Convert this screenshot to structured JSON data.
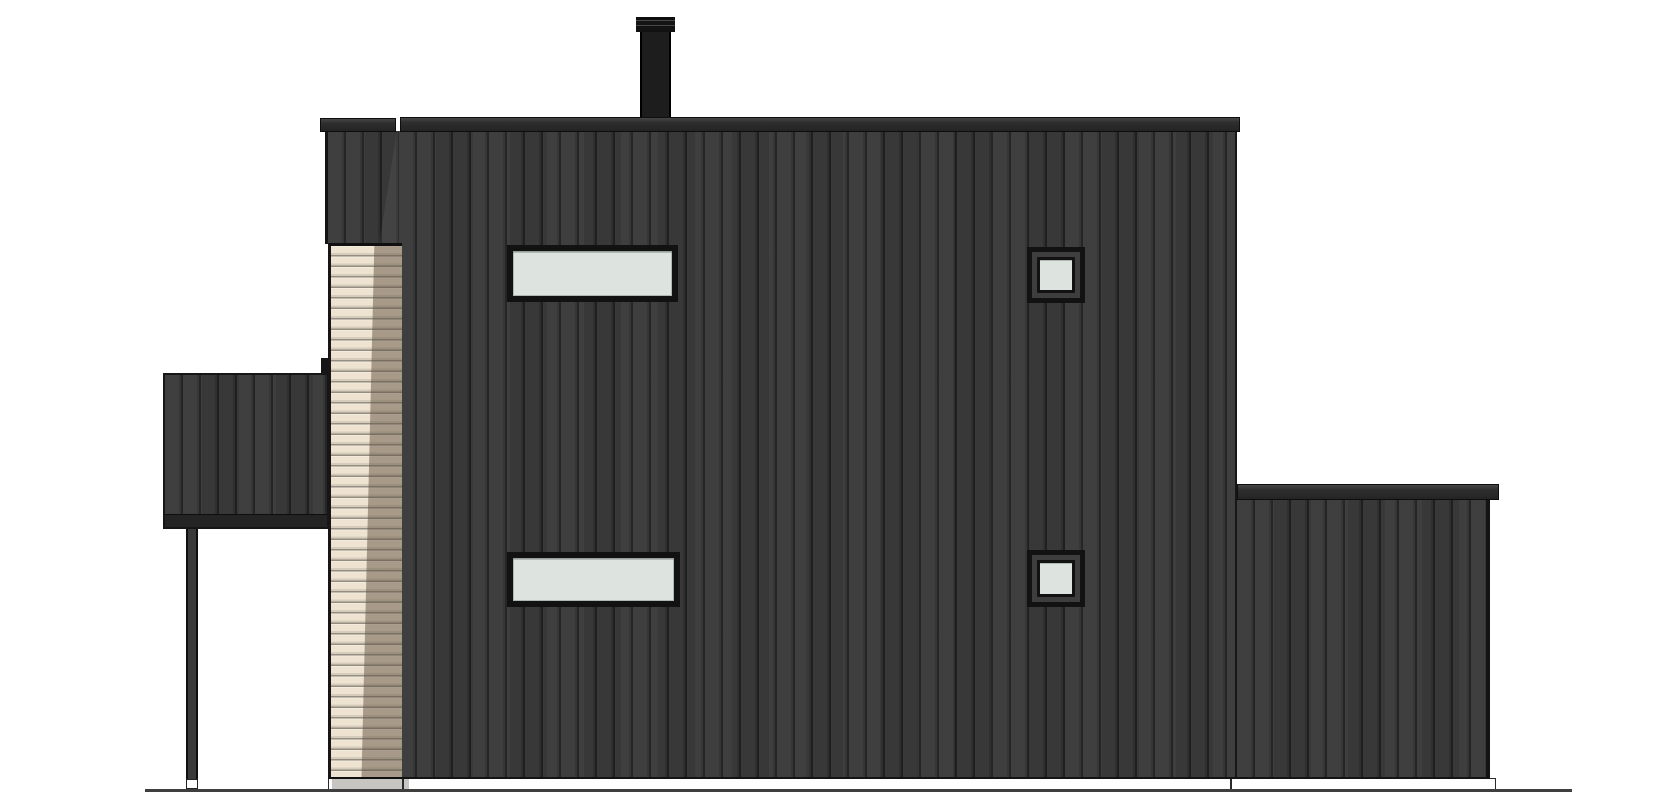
{
  "drawing": {
    "type": "architectural-elevation",
    "view": "side-elevation"
  },
  "palette": {
    "background": "#ffffff",
    "siding_dark": "#3a3a3a",
    "siding_groove": "#232323",
    "roof_cap": "#2b2b2b",
    "chimney": "#161616",
    "wood_slats": "#eee3d0",
    "wood_slat_shadow": "#9c8f7b",
    "glass": "#dde3df",
    "window_frame": "#121212",
    "foundation": "#ffffff",
    "foundation_shade": "#c6c5c2",
    "ground": "#3f3f3f",
    "post": "#2e2e2e"
  },
  "scene": {
    "canvas": {
      "x": 0,
      "y": 0,
      "w": 1670,
      "h": 800
    },
    "ground_line": {
      "x": 145,
      "y": 789,
      "w": 1427,
      "h": 3
    },
    "foundation": {
      "x": 328,
      "y": 778,
      "w": 1168,
      "h": 12
    },
    "foundation_shade": {
      "x": 332,
      "y": 779,
      "w": 77,
      "h": 10
    },
    "foundation_joint_left": {
      "x": 402,
      "y": 778,
      "w": 2,
      "h": 12
    },
    "foundation_joint_right": {
      "x": 1230,
      "y": 778,
      "w": 2,
      "h": 12
    },
    "main_wall": {
      "x": 399,
      "y": 131,
      "w": 838,
      "h": 648
    },
    "main_roof_cap": {
      "x": 400,
      "y": 117,
      "w": 840,
      "h": 15
    },
    "left_tower_upper": {
      "x": 325,
      "y": 131,
      "w": 74,
      "h": 113
    },
    "left_roof_cap": {
      "x": 320,
      "y": 118,
      "w": 76,
      "h": 14
    },
    "slat_column": {
      "x": 328,
      "y": 243,
      "w": 74,
      "h": 536
    },
    "canopy": {
      "x": 163,
      "y": 373,
      "w": 166,
      "h": 156
    },
    "canopy_flashing": {
      "x": 321,
      "y": 358,
      "w": 9,
      "h": 16
    },
    "post": {
      "x": 186,
      "y": 529,
      "w": 12,
      "h": 250
    },
    "post_foot": {
      "x": 186,
      "y": 779,
      "w": 12,
      "h": 10
    },
    "chimney_body": {
      "x": 640,
      "y": 30,
      "w": 31,
      "h": 90
    },
    "chimney_cap": {
      "x": 636,
      "y": 17,
      "w": 39,
      "h": 15
    },
    "ext_wall": {
      "x": 1237,
      "y": 498,
      "w": 253,
      "h": 281
    },
    "ext_roof_cap": {
      "x": 1237,
      "y": 484,
      "w": 262,
      "h": 16
    },
    "window_long_upper": {
      "x": 507,
      "y": 245,
      "w": 171,
      "h": 57
    },
    "window_long_lower": {
      "x": 507,
      "y": 552,
      "w": 173,
      "h": 55
    },
    "window_small_upper": {
      "x": 1027,
      "y": 247,
      "w": 58,
      "h": 56
    },
    "window_small_lower": {
      "x": 1027,
      "y": 550,
      "w": 58,
      "h": 57
    }
  }
}
